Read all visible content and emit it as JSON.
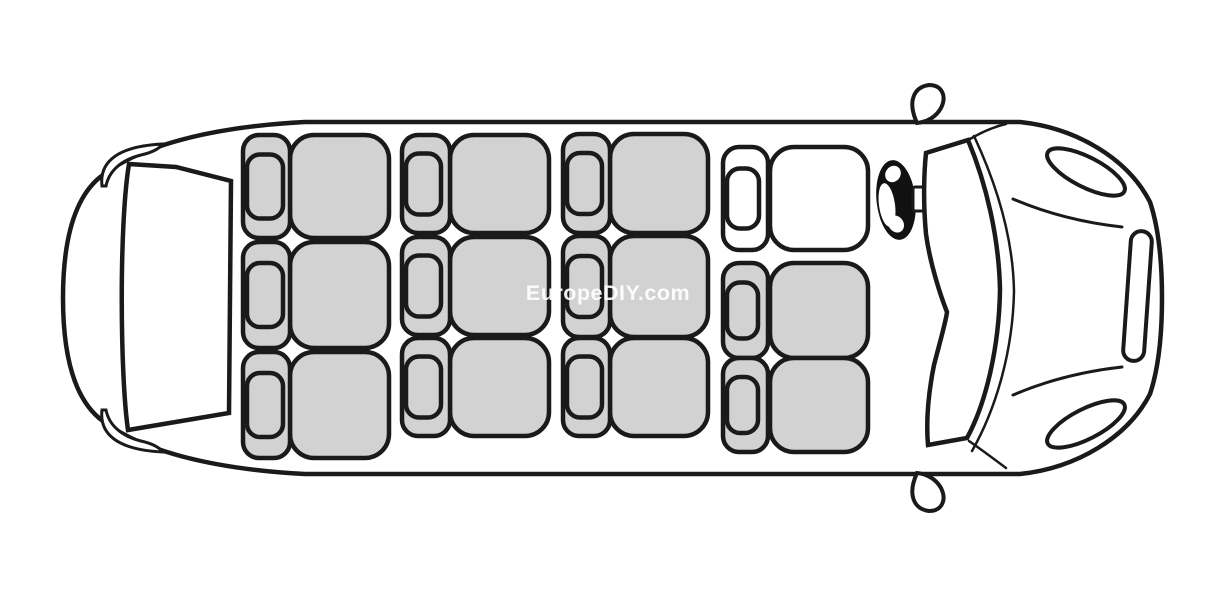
{
  "page": {
    "background": "#ffffff",
    "width": 1225,
    "height": 598
  },
  "watermark": {
    "text": "EuropeDIY.com",
    "color": "#ffffff"
  },
  "diagram": {
    "type": "vehicle-seating-plan",
    "view": "top-down",
    "vehicle": "minibus",
    "orientation": {
      "front": "right",
      "rear": "left"
    },
    "colors": {
      "passenger_seat_fill": "#d2d2d2",
      "driver_seat_fill": "#ffffff",
      "outline": "#1a1a1a",
      "steering_wheel_fill": "#111111",
      "background": "#ffffff"
    },
    "seat_counts": {
      "total": 12,
      "passenger": 11,
      "driver": 1
    },
    "parts": [
      "van-body-outline",
      "rear-hatch-window",
      "taillight-upper",
      "taillight-lower",
      "driver-side-mirror",
      "passenger-side-mirror",
      "windshield",
      "windshield-outer-edge",
      "hood-crease-upper",
      "hood-crease-lower",
      "headlight-upper",
      "headlight-lower",
      "front-grille",
      "steering-wheel",
      "steering-column"
    ],
    "seat_style": {
      "backrest_rx": 16,
      "headrest_rx": 13,
      "cushion_rx": 24,
      "stroke_width": 4.5
    },
    "seats": [
      {
        "id": "rear-bench-seat-1",
        "group": "rear-bench",
        "kind": "passenger",
        "back_x": 243,
        "back_w": 47,
        "cushion_x": 290,
        "cushion_w": 99,
        "y": 135,
        "h": 103,
        "hr_w": 36,
        "hr_h": 64
      },
      {
        "id": "rear-bench-seat-2",
        "group": "rear-bench",
        "kind": "passenger",
        "back_x": 243,
        "back_w": 47,
        "cushion_x": 290,
        "cushion_w": 99,
        "y": 242,
        "h": 106,
        "hr_w": 36,
        "hr_h": 64
      },
      {
        "id": "rear-bench-seat-3",
        "group": "rear-bench",
        "kind": "passenger",
        "back_x": 243,
        "back_w": 47,
        "cushion_x": 290,
        "cushion_w": 99,
        "y": 352,
        "h": 106,
        "hr_w": 36,
        "hr_h": 64
      },
      {
        "id": "middle-bench-1-seat-1",
        "group": "middle-bench-1",
        "kind": "passenger",
        "back_x": 402,
        "back_w": 48,
        "cushion_x": 450,
        "cushion_w": 99,
        "y": 135,
        "h": 98,
        "hr_w": 35,
        "hr_h": 61
      },
      {
        "id": "middle-bench-1-seat-2",
        "group": "middle-bench-1",
        "kind": "passenger",
        "back_x": 402,
        "back_w": 48,
        "cushion_x": 450,
        "cushion_w": 99,
        "y": 237,
        "h": 98,
        "hr_w": 35,
        "hr_h": 61
      },
      {
        "id": "middle-bench-1-seat-3",
        "group": "middle-bench-1",
        "kind": "passenger",
        "back_x": 402,
        "back_w": 48,
        "cushion_x": 450,
        "cushion_w": 99,
        "y": 338,
        "h": 98,
        "hr_w": 35,
        "hr_h": 61
      },
      {
        "id": "middle-bench-2-seat-1",
        "group": "middle-bench-2",
        "kind": "passenger",
        "back_x": 563,
        "back_w": 47,
        "cushion_x": 610,
        "cushion_w": 98,
        "y": 134,
        "h": 99,
        "hr_w": 35,
        "hr_h": 61
      },
      {
        "id": "middle-bench-2-seat-2",
        "group": "middle-bench-2",
        "kind": "passenger",
        "back_x": 563,
        "back_w": 47,
        "cushion_x": 610,
        "cushion_w": 98,
        "y": 236,
        "h": 101,
        "hr_w": 35,
        "hr_h": 61
      },
      {
        "id": "middle-bench-2-seat-3",
        "group": "middle-bench-2",
        "kind": "passenger",
        "back_x": 563,
        "back_w": 47,
        "cushion_x": 610,
        "cushion_w": 98,
        "y": 338,
        "h": 98,
        "hr_w": 35,
        "hr_h": 61
      },
      {
        "id": "driver-seat",
        "group": "front-row",
        "kind": "driver",
        "back_x": 723,
        "back_w": 45,
        "cushion_x": 770,
        "cushion_w": 98,
        "y": 147,
        "h": 103,
        "hr_w": 32,
        "hr_h": 60
      },
      {
        "id": "front-passenger-seat-1",
        "group": "front-row",
        "kind": "passenger",
        "back_x": 723,
        "back_w": 45,
        "cushion_x": 770,
        "cushion_w": 98,
        "y": 263,
        "h": 95,
        "hr_w": 31,
        "hr_h": 56
      },
      {
        "id": "front-passenger-seat-2",
        "group": "front-row",
        "kind": "passenger",
        "back_x": 723,
        "back_w": 45,
        "cushion_x": 770,
        "cushion_w": 98,
        "y": 358,
        "h": 94,
        "hr_w": 31,
        "hr_h": 56
      }
    ]
  }
}
